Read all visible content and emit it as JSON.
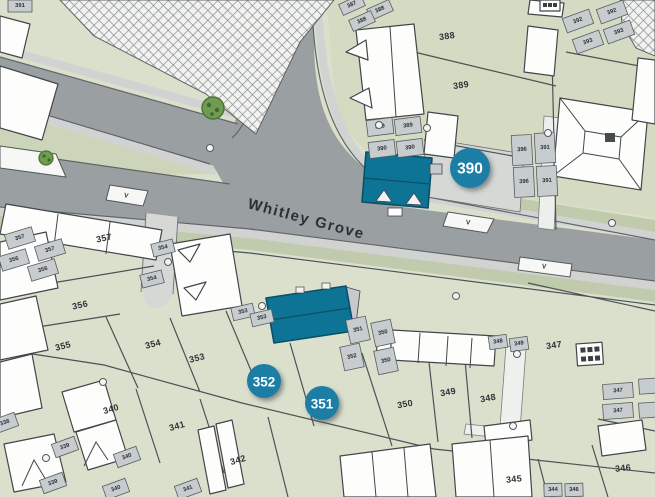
{
  "street_label": "Whitley Grove",
  "badges": [
    {
      "label": "390"
    },
    {
      "label": "352"
    },
    {
      "label": "351"
    }
  ],
  "labels_large": [
    {
      "t": "388",
      "x": 447,
      "y": 36,
      "r": -8
    },
    {
      "t": "389",
      "x": 461,
      "y": 85,
      "r": -8
    },
    {
      "t": "357",
      "x": 104,
      "y": 238,
      "r": -12
    },
    {
      "t": "356",
      "x": 80,
      "y": 305,
      "r": -12
    },
    {
      "t": "355",
      "x": 63,
      "y": 346,
      "r": -14
    },
    {
      "t": "354",
      "x": 153,
      "y": 344,
      "r": -14
    },
    {
      "t": "353",
      "x": 197,
      "y": 358,
      "r": -14
    },
    {
      "t": "340",
      "x": 111,
      "y": 409,
      "r": -16
    },
    {
      "t": "341",
      "x": 177,
      "y": 426,
      "r": -16
    },
    {
      "t": "342",
      "x": 238,
      "y": 460,
      "r": -16
    },
    {
      "t": "350",
      "x": 405,
      "y": 404,
      "r": -10
    },
    {
      "t": "349",
      "x": 448,
      "y": 392,
      "r": -10
    },
    {
      "t": "348",
      "x": 488,
      "y": 398,
      "r": -10
    },
    {
      "t": "347",
      "x": 554,
      "y": 345,
      "r": -8
    },
    {
      "t": "345",
      "x": 514,
      "y": 479,
      "r": -6
    },
    {
      "t": "346",
      "x": 623,
      "y": 468,
      "r": -6
    }
  ],
  "cells": [
    {
      "t": "391",
      "x": 20,
      "y": 6,
      "r": 0,
      "w": 24,
      "h": 12
    },
    {
      "t": "387",
      "x": 352,
      "y": 5,
      "r": -24,
      "w": 24,
      "h": 12
    },
    {
      "t": "388",
      "x": 380,
      "y": 10,
      "r": -24,
      "w": 24,
      "h": 12
    },
    {
      "t": "388",
      "x": 362,
      "y": 21,
      "r": -24,
      "w": 24,
      "h": 12
    },
    {
      "t": "389",
      "x": 380,
      "y": 127,
      "r": -7,
      "w": 26,
      "h": 16
    },
    {
      "t": "389",
      "x": 408,
      "y": 126,
      "r": -7,
      "w": 26,
      "h": 16
    },
    {
      "t": "390",
      "x": 382,
      "y": 149,
      "r": -7,
      "w": 26,
      "h": 16
    },
    {
      "t": "390",
      "x": 410,
      "y": 148,
      "r": -7,
      "w": 26,
      "h": 16
    },
    {
      "t": "392",
      "x": 578,
      "y": 21,
      "r": -20,
      "w": 28,
      "h": 15
    },
    {
      "t": "392",
      "x": 612,
      "y": 12,
      "r": -20,
      "w": 28,
      "h": 15
    },
    {
      "t": "393",
      "x": 619,
      "y": 32,
      "r": -20,
      "w": 28,
      "h": 15
    },
    {
      "t": "393",
      "x": 588,
      "y": 42,
      "r": -20,
      "w": 28,
      "h": 15
    },
    {
      "t": "396",
      "x": 522,
      "y": 150,
      "r": -3,
      "w": 20,
      "h": 30
    },
    {
      "t": "391",
      "x": 545,
      "y": 148,
      "r": -3,
      "w": 20,
      "h": 30
    },
    {
      "t": "396",
      "x": 524,
      "y": 182,
      "r": -3,
      "w": 20,
      "h": 30
    },
    {
      "t": "391",
      "x": 547,
      "y": 181,
      "r": -3,
      "w": 20,
      "h": 30
    },
    {
      "t": "357",
      "x": 20,
      "y": 238,
      "r": -17,
      "w": 28,
      "h": 15
    },
    {
      "t": "357",
      "x": 50,
      "y": 250,
      "r": -17,
      "w": 28,
      "h": 15
    },
    {
      "t": "356",
      "x": 14,
      "y": 260,
      "r": -17,
      "w": 28,
      "h": 15
    },
    {
      "t": "356",
      "x": 43,
      "y": 270,
      "r": -17,
      "w": 28,
      "h": 15
    },
    {
      "t": "354",
      "x": 163,
      "y": 248,
      "r": -14,
      "w": 22,
      "h": 13
    },
    {
      "t": "354",
      "x": 152,
      "y": 279,
      "r": -14,
      "w": 22,
      "h": 13
    },
    {
      "t": "353",
      "x": 243,
      "y": 312,
      "r": -13,
      "w": 22,
      "h": 13
    },
    {
      "t": "353",
      "x": 262,
      "y": 318,
      "r": -13,
      "w": 22,
      "h": 13
    },
    {
      "t": "351",
      "x": 358,
      "y": 330,
      "r": -12,
      "w": 20,
      "h": 24
    },
    {
      "t": "350",
      "x": 383,
      "y": 333,
      "r": -12,
      "w": 20,
      "h": 24
    },
    {
      "t": "352",
      "x": 352,
      "y": 357,
      "r": -12,
      "w": 20,
      "h": 24
    },
    {
      "t": "350",
      "x": 386,
      "y": 361,
      "r": -12,
      "w": 20,
      "h": 24
    },
    {
      "t": "348",
      "x": 498,
      "y": 342,
      "r": -8,
      "w": 18,
      "h": 13
    },
    {
      "t": "349",
      "x": 519,
      "y": 344,
      "r": -8,
      "w": 18,
      "h": 13
    },
    {
      "t": "338",
      "x": 5,
      "y": 423,
      "r": -20,
      "w": 24,
      "h": 14
    },
    {
      "t": "339",
      "x": 65,
      "y": 447,
      "r": -20,
      "w": 24,
      "h": 14
    },
    {
      "t": "340",
      "x": 127,
      "y": 457,
      "r": -20,
      "w": 24,
      "h": 14
    },
    {
      "t": "339",
      "x": 53,
      "y": 483,
      "r": -20,
      "w": 24,
      "h": 14
    },
    {
      "t": "340",
      "x": 116,
      "y": 489,
      "r": -20,
      "w": 24,
      "h": 14
    },
    {
      "t": "341",
      "x": 188,
      "y": 489,
      "r": -20,
      "w": 24,
      "h": 14
    },
    {
      "t": "347",
      "x": 618,
      "y": 391,
      "r": -4,
      "w": 30,
      "h": 15
    },
    {
      "t": "347",
      "x": 618,
      "y": 411,
      "r": -4,
      "w": 30,
      "h": 15
    },
    {
      "t": "",
      "x": 650,
      "y": 386,
      "r": -4,
      "w": 22,
      "h": 15
    },
    {
      "t": "",
      "x": 650,
      "y": 410,
      "r": -4,
      "w": 22,
      "h": 15
    },
    {
      "t": "344",
      "x": 553,
      "y": 490,
      "r": -2,
      "w": 18,
      "h": 13
    },
    {
      "t": "346",
      "x": 574,
      "y": 490,
      "r": -2,
      "w": 18,
      "h": 13
    }
  ],
  "visitor_labels": [
    {
      "t": "V",
      "x": 468,
      "y": 223,
      "r": 8
    },
    {
      "t": "V",
      "x": 544,
      "y": 267,
      "r": 8
    },
    {
      "t": "V",
      "x": 126,
      "y": 196,
      "r": 12
    }
  ],
  "colors": {
    "background_green": "#dbe0cd",
    "north_green": "#d4dbc2",
    "verge_green": "#c0cbae",
    "road_gray": "#9aa0a2",
    "sidewalk_gray": "#d0d3d1",
    "court_gray": "#d5d8d5",
    "highlight_teal": "#0e7496",
    "badge_teal": "#1b7ea5",
    "building_white": "#fdfdfc",
    "outline_dark": "#41464a"
  }
}
